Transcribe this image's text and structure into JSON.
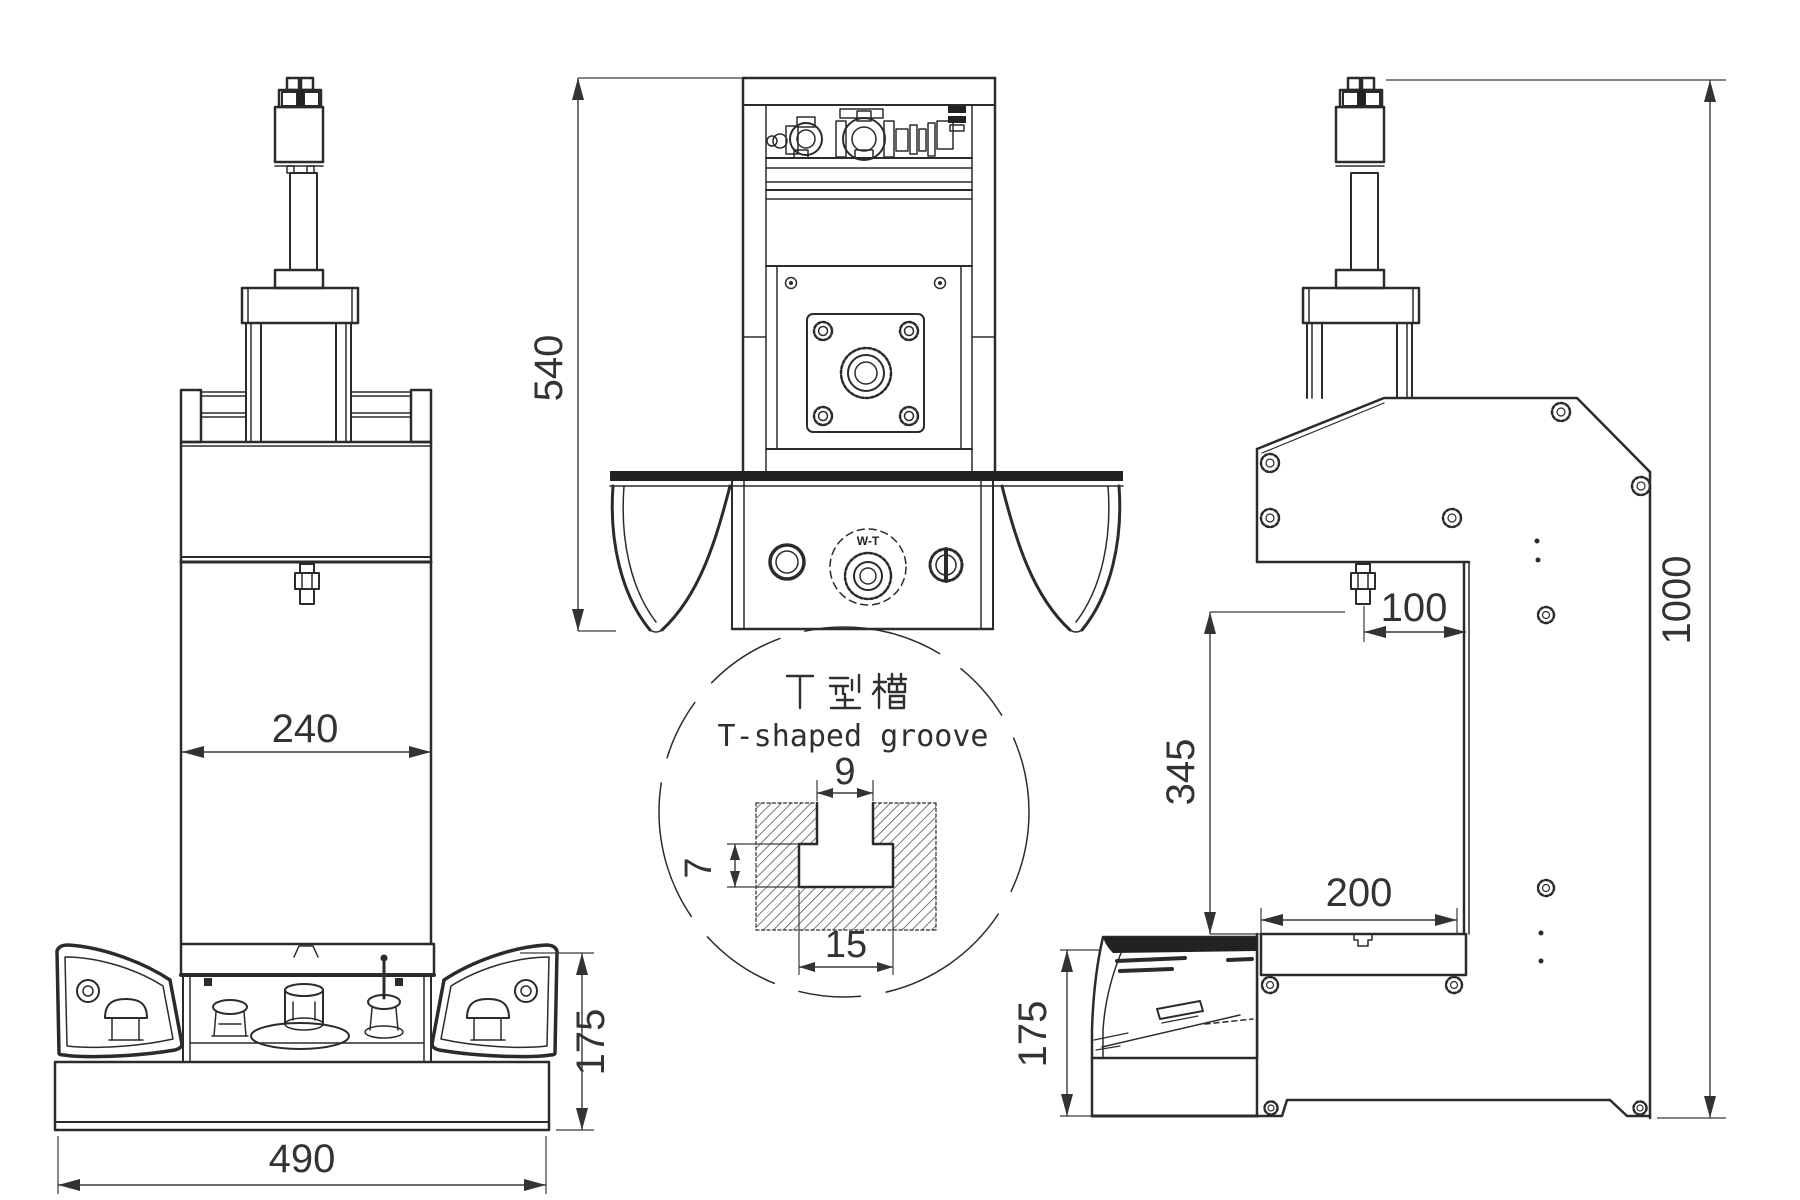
{
  "meta": {
    "background": "#ffffff",
    "line_color": "#2b2b2b",
    "dim_text_color": "#333333"
  },
  "front_view": {
    "dim_column_width": "240",
    "dim_base_width": "490",
    "dim_base_height": "175"
  },
  "panel_view": {
    "dim_upper_height": "540",
    "knob_label": "W-T"
  },
  "side_view": {
    "dim_throat_depth": "100",
    "dim_daylight_opening": "345",
    "dim_table_depth": "200",
    "dim_base_height": "175",
    "dim_total_height": "1000"
  },
  "detail_callout": {
    "title_cn": "T 型 槽",
    "title_en": "T-shaped groove",
    "dim_neck_width": "9",
    "dim_cavity_height": "7",
    "dim_cavity_width": "15"
  }
}
